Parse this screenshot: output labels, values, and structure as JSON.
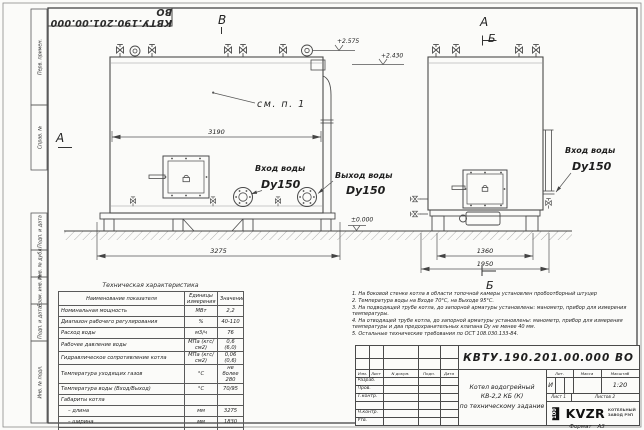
{
  "doc": {
    "designation": "КВТУ.190.201.00.000 ВО"
  },
  "margin_labels": [
    "Перв. примен.",
    "Справ. №",
    "Подп. и дата",
    "Инв. № дубл.",
    "Взам. инв. №",
    "Подп. и дата",
    "Инв. № подл."
  ],
  "drawing": {
    "sections": {
      "v": "В",
      "a_left": "А",
      "a_right": "А",
      "b_right": "Б",
      "b_bottom": "Б"
    },
    "elevations": {
      "e1": "+2.575",
      "e2": "+2.430",
      "zero": "±0.000"
    },
    "dims": {
      "d3190": "3190",
      "d3275": "3275",
      "d1360": "1360",
      "d1950": "1950"
    },
    "labels": {
      "see_note": "см. п. 1",
      "inlet_front": "Вход воды",
      "inlet_front_dn": "Dy150",
      "outlet": "Выход воды",
      "outlet_dn": "Dy150",
      "inlet_side": "Вход воды",
      "inlet_side_dn": "Dy150"
    }
  },
  "tech_table": {
    "title": "Техническая характеристика",
    "headers": [
      "Наименование показателя",
      "Единицы измерения",
      "Значение"
    ],
    "rows": [
      [
        "Номинальная мощность",
        "МВт",
        "2,2"
      ],
      [
        "Диапазон рабочего регулирования",
        "%",
        "40-110"
      ],
      [
        "Расход воды",
        "м3/ч",
        "76"
      ],
      [
        "Рабочее давление воды",
        "МПа (кгс/см2)",
        "0,6 (6,0)"
      ],
      [
        "Гидравлическое сопротивление котла",
        "МПа (кгс/см2)",
        "0,06 (0,6)"
      ],
      [
        "Температура уходящих газов",
        "°С",
        "не более 280"
      ],
      [
        "Температура воды (Вход/Выход)",
        "°С",
        "70/95"
      ],
      [
        "Габариты котла",
        "",
        ""
      ],
      [
        "– длина",
        "мм",
        "3275"
      ],
      [
        "– ширина",
        "мм",
        "1830"
      ],
      [
        "– высота",
        "мм",
        "2460"
      ]
    ]
  },
  "notes": {
    "items": [
      "1. На боковой стенке котла в области топочной камеры установлен пробоотборный штуцер",
      "2. Температура воды на Входе 70°С, на Выходе 95°С.",
      "3. На подводящей трубе котла, до запорной арматуры установлены: манометр, прибор для измерения температуры.",
      "4. На отводящей трубе котла, до запорной арматуры установлены: манометр, прибор для измерения температуры и два предохранительных клапана Dу не менее 40 мм.",
      "5. Остальные технические требования по ОСТ 108.030.133-84."
    ]
  },
  "title_block": {
    "designation": "КВТУ.190.201.00.000 ВО",
    "name_line1": "Котел водогрейный",
    "name_line2": "КВ-2,2 КБ (К)",
    "name_line3": "по техническому задание",
    "cols": [
      "Изм.",
      "Лист",
      "N докум.",
      "Подп.",
      "Дата"
    ],
    "rows": [
      "Разраб.",
      "Пров.",
      "Т.контр.",
      "Н.контр.",
      "Утв."
    ],
    "lit_label": "Лит.",
    "lit_value": "И",
    "mass_label": "Масса",
    "scale_label": "Масштаб",
    "scale_value": "1:20",
    "sheet_label": "Лист",
    "sheet_value": "1",
    "sheets_label": "Листов",
    "sheets_value": "2",
    "logo_mark": "100",
    "logo_name": "KVZR",
    "logo_line1": "КОТЕЛЬНЫЙ",
    "logo_line2": "ЗАВОД РЭП",
    "format_label": "Формат",
    "format_value": "А3"
  }
}
